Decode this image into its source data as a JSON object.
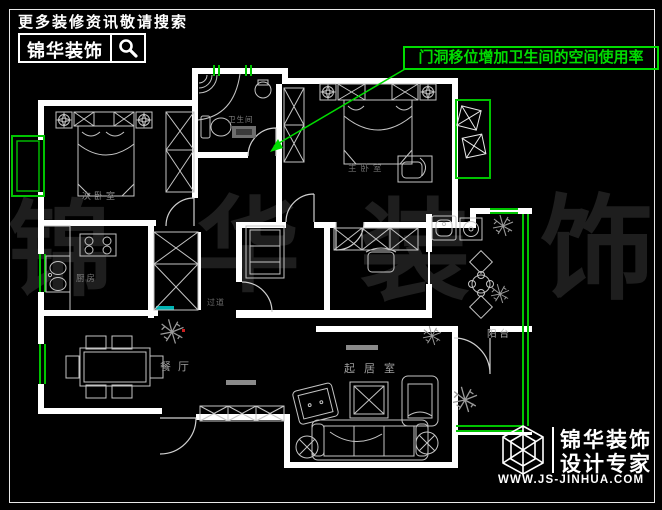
{
  "topbar": {
    "tagline": "更多装修资讯敬请搜索",
    "brand": "锦华装饰"
  },
  "annotation": {
    "text": "门洞移位增加卫生间的空间使用率"
  },
  "watermark": {
    "chars": [
      "锦",
      "华",
      "装",
      "饰"
    ]
  },
  "rooms": [
    {
      "label": "次卧室"
    },
    {
      "label": "卫生间"
    },
    {
      "label": "主卧室"
    },
    {
      "label": "厨房"
    },
    {
      "label": "过道"
    },
    {
      "label": "餐厅"
    },
    {
      "label": "起居室"
    },
    {
      "label": "阳台"
    }
  ],
  "footer": {
    "brand": "锦华装饰",
    "subtitle": "设计专家",
    "website": "WWW.JS-JINHUA.COM"
  },
  "colors": {
    "background": "#000000",
    "wall": "#ffffff",
    "furniture": "#c4c4c4",
    "accent_green": "#00dc00",
    "window_green": "#00c400",
    "cyan": "#00b4b4",
    "label_gray": "#9a9a9a",
    "watermark_gray": "#1e1e1e",
    "red_dot": "#cc2020"
  }
}
